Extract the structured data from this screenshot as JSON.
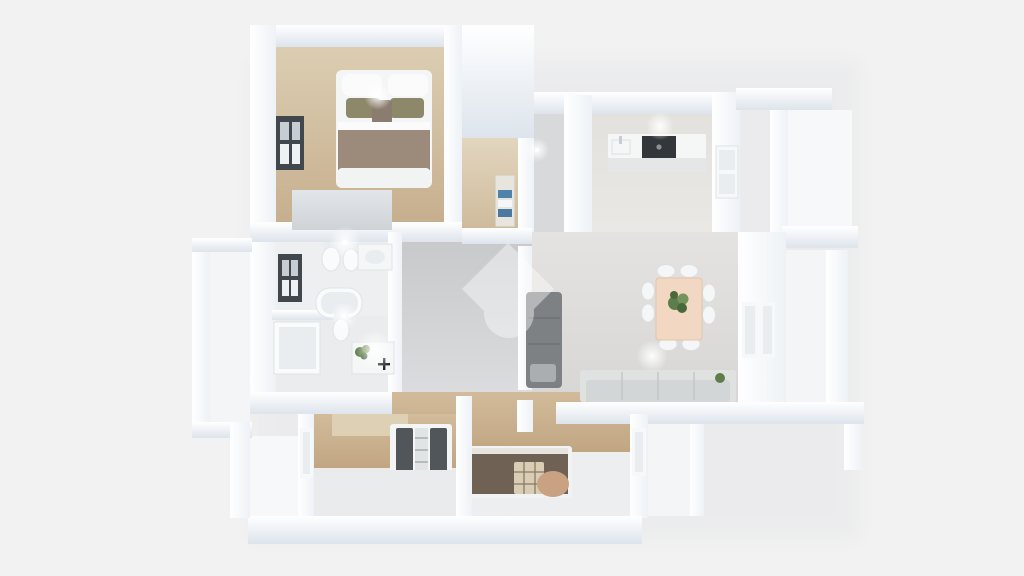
{
  "meta": {
    "description": "3D bird's-eye render of an apartment floor plan with furniture, no visible text",
    "watermark_icon": "home-diamond-watermark"
  },
  "canvas": {
    "background": "#f2f2f2"
  },
  "watermark": {
    "color": "#ffffff",
    "opacity": "0.42"
  },
  "palette": {
    "wall_white": "#fdfdfe",
    "wall_hi": "#ffffff",
    "wall_shade": "#dde4ec",
    "wall_mid": "#eef2f6",
    "wood_hi": "#dccdb2",
    "wood_lo": "#c6af8e",
    "wood_light_hi": "#e2d6bf",
    "wood_light_lo": "#cfbb9c",
    "wood2_hi": "#d2bb9b",
    "wood2_lo": "#c1a581",
    "hall_hi": "#c7c8ca",
    "hall_lo": "#dcdddf",
    "kitchen_hi": "#e3e1dd",
    "kitchen_lo": "#eae8e4",
    "living_hi": "#e4e3e1",
    "living_lo": "#d6d5d4",
    "bath_floor": "#edeff0",
    "bath_floor2": "#eaeced",
    "balcony_floor": "#f4f5f6",
    "terrace_floor": "#f7f8f9",
    "hallN_floor": "#d8d9db",
    "b3_gray": "#eaebec",
    "b4_gray": "#edeeef",
    "window_dark": "#42474d",
    "window_pane_lit": "#eef2f4",
    "window_pane_dim": "#c7ced3",
    "window_white": "#f6f8f9",
    "window_pane_soft": "#e9edef",
    "frame_soft": "#dfe3e6",
    "stove_dark": "#33373b",
    "counter_top": "#f5f6f6",
    "counter_front": "#e4e6e7",
    "fixture_white": "#fafbfb",
    "fixture_line": "#dfe4e7",
    "fixture_inner": "#e9edef",
    "wardrobe_hi": "#e3e6e9",
    "wardrobe_lo": "#ced3d7",
    "mattress_white": "#f4f5f5",
    "pillow_white": "#fbfbfb",
    "pillow_olive": "#8d8869",
    "cushion_brown": "#8a7c6e",
    "blanket_taupe": "#9c8a7a",
    "bed_foot": "#f2f3f3",
    "sofa_dark": "#7e8184",
    "sofa_dark_seam": "#6e7174",
    "sofa_dark_pillow": "#aaaeb0",
    "sofa_light_back": "#e0e2e2",
    "sofa_light_body": "#d3d6d6",
    "sofa_light_seam": "#c2c5c5",
    "table_wood": "#f2d8c2",
    "table_edge": "#e4c3aa",
    "chair_white": "#f5f6f7",
    "chair_edge": "#dcdfe1",
    "plant_green": "#5d7d4a",
    "plant_green_dark": "#49693a",
    "plant_green_light": "#74945c",
    "headboard_beige": "#ded0b4",
    "pillow_stripe_dark": "#51565a",
    "pillow_stripe_light": "#e1e4e5",
    "stripe_line": "#9ba0a3",
    "daybed_brown": "#6f6154",
    "daybed_edge": "#e7e3de",
    "daybed_frame": "#f1f2f3",
    "plaid_base": "#d9cdb6",
    "plaid_line": "#8a7a62",
    "cushion_tan": "#c9a183",
    "towel_blue": "#5083ab",
    "towel_blue2": "#4b7aa0",
    "shelf_wood": "#e8e4de",
    "faucet_black": "#24282c",
    "glow_core": "#ffffff",
    "shadow_soft": "#e6e7e9"
  }
}
